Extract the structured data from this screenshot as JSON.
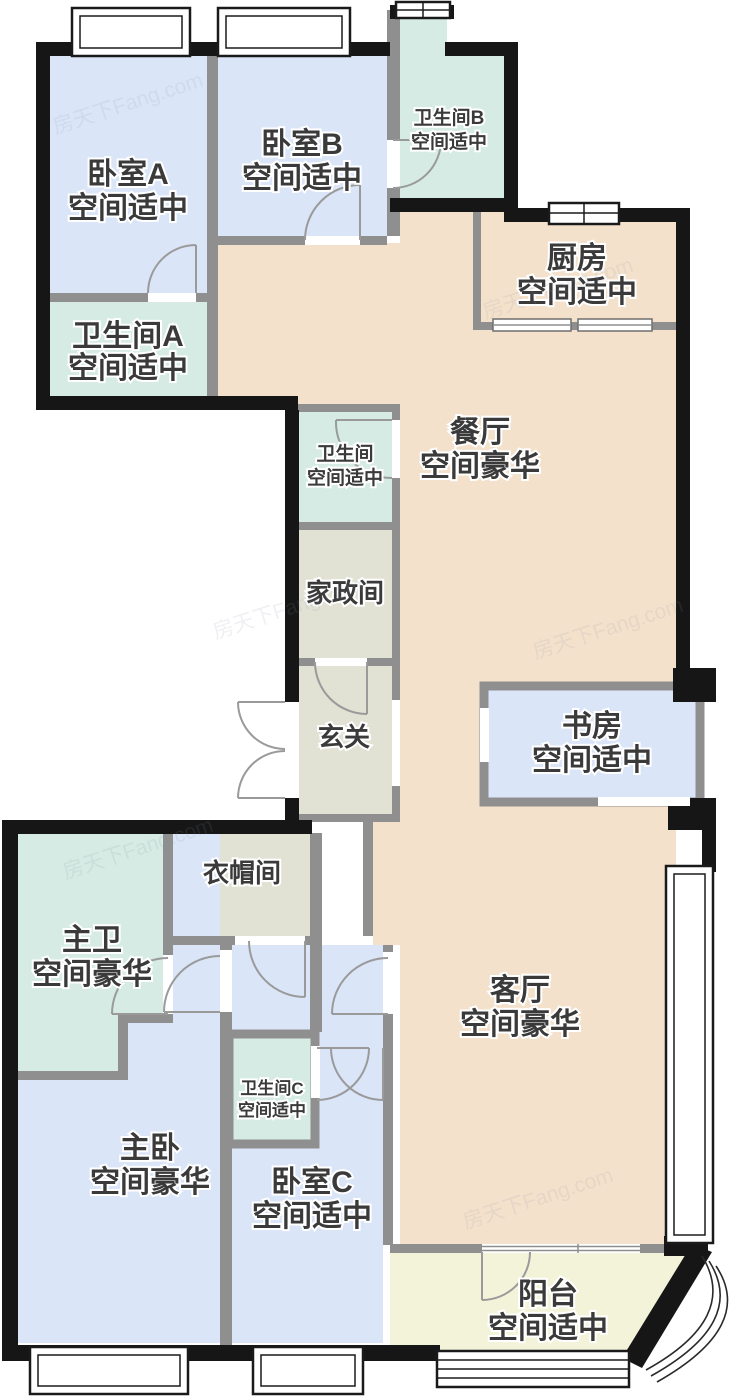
{
  "watermark": "房天下Fang.com",
  "colors": {
    "bedroom": "#dbe5f8",
    "bathroom": "#d5ebe3",
    "living_dining": "#f3e1cc",
    "utility": "#e1e1d4",
    "balcony": "#f3f3da",
    "outer_wall": "#161616",
    "partition_wall": "#8f8f8f",
    "label_text": "#3a3a3a"
  },
  "rooms": [
    {
      "id": "bedroom-a",
      "name": "卧室A",
      "size_label": "空间适中"
    },
    {
      "id": "bedroom-b",
      "name": "卧室B",
      "size_label": "空间适中"
    },
    {
      "id": "bathroom-b",
      "name": "卫生间B",
      "size_label": "空间适中"
    },
    {
      "id": "kitchen",
      "name": "厨房",
      "size_label": "空间适中"
    },
    {
      "id": "bathroom-a",
      "name": "卫生间A",
      "size_label": "空间适中"
    },
    {
      "id": "bathroom",
      "name": "卫生间",
      "size_label": "空间适中"
    },
    {
      "id": "dining-room",
      "name": "餐厅",
      "size_label": "空间豪华"
    },
    {
      "id": "laundry-room",
      "name": "家政间",
      "size_label": ""
    },
    {
      "id": "entry-hall",
      "name": "玄关",
      "size_label": ""
    },
    {
      "id": "study",
      "name": "书房",
      "size_label": "空间适中"
    },
    {
      "id": "cloakroom",
      "name": "衣帽间",
      "size_label": ""
    },
    {
      "id": "master-bathroom",
      "name": "主卫",
      "size_label": "空间豪华"
    },
    {
      "id": "living-room",
      "name": "客厅",
      "size_label": "空间豪华"
    },
    {
      "id": "bathroom-c",
      "name": "卫生间C",
      "size_label": "空间适中"
    },
    {
      "id": "master-bedroom",
      "name": "主卧",
      "size_label": "空间豪华"
    },
    {
      "id": "bedroom-c",
      "name": "卧室C",
      "size_label": "空间适中"
    },
    {
      "id": "balcony",
      "name": "阳台",
      "size_label": "空间适中"
    }
  ]
}
